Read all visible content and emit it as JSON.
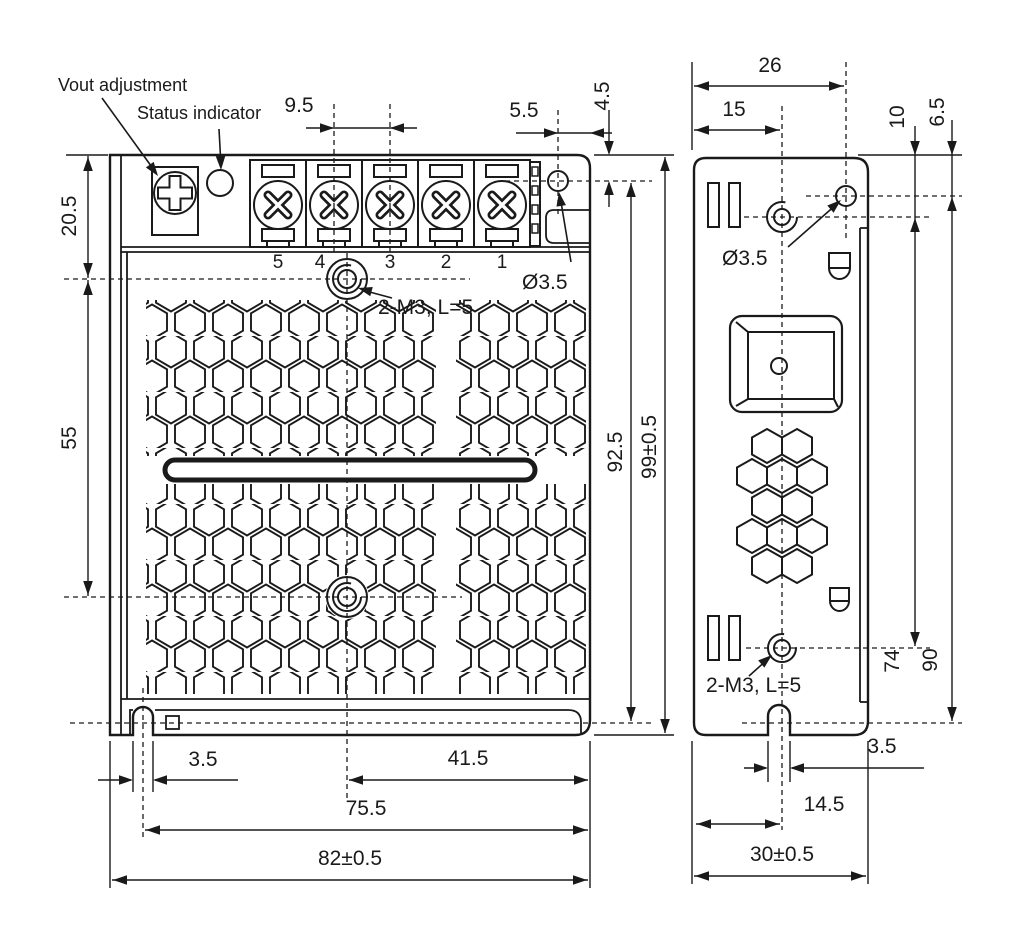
{
  "drawing": {
    "annotations": {
      "vout_adjustment": "Vout adjustment",
      "status_indicator": "Status indicator"
    },
    "front_view": {
      "terminals": [
        "5",
        "4",
        "3",
        "2",
        "1"
      ],
      "labels": {
        "mounting_hole": "Ø3.5",
        "threaded_holes": "2-M3, L=5"
      },
      "dims": {
        "terminal_pitch": "9.5",
        "hole_to_edge": "5.5",
        "hole_to_top": "4.5",
        "top_to_upper_hole": "20.5",
        "hole_spacing": "55",
        "hole_to_bottom": "92.5",
        "overall_height": "99±0.5",
        "slot_width": "3.5",
        "center_to_edge": "41.5",
        "slot_to_edge": "75.5",
        "overall_width": "82±0.5"
      }
    },
    "side_view": {
      "labels": {
        "mounting_hole": "Ø3.5",
        "threaded_holes": "2-M3, L=5"
      },
      "dims": {
        "hole_offset": "26",
        "center_offset": "15",
        "thread_to_top": "10",
        "hole_to_top": "6.5",
        "thread_spacing": "74",
        "hole_to_bottom": "90",
        "slot_width": "3.5",
        "slot_center": "14.5",
        "overall_depth": "30±0.5"
      }
    },
    "colors": {
      "line": "#1a1a1a",
      "background": "#ffffff"
    }
  }
}
